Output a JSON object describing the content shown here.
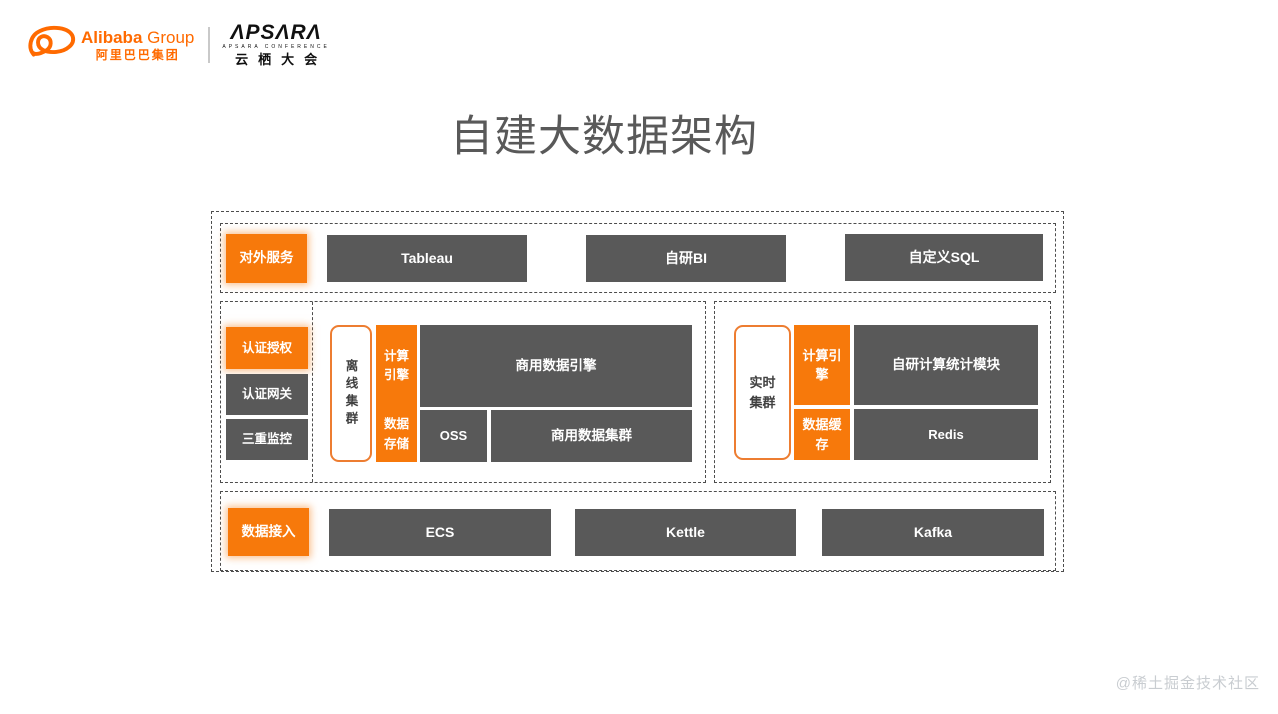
{
  "logos": {
    "alibaba": {
      "name_bold": "Alibaba",
      "name_light": " Group",
      "cn": "阿里巴巴集团"
    },
    "apsara": {
      "wordmark": "ΛPSΛRΛ",
      "subtitle": "APSARA CONFERENCE",
      "cn": "云栖大会"
    }
  },
  "title": "自建大数据架构",
  "watermark": "@稀土掘金技术社区",
  "colors": {
    "logo_orange": "#FF6A00",
    "block_orange": "#F7790B",
    "block_gray": "#595959",
    "dashed_border": "#4d4d4d",
    "title_gray": "#595959",
    "cluster_border_orange": "#ED7D31",
    "watermark_gray": "#c9cdd1"
  },
  "diagram": {
    "external_service": {
      "label": "对外服务"
    },
    "top_items": [
      {
        "label": "Tableau"
      },
      {
        "label": "自研BI"
      },
      {
        "label": "自定义SQL"
      }
    ],
    "auth_items": [
      {
        "label": "认证授权",
        "color": "orange"
      },
      {
        "label": "认证网关",
        "color": "gray"
      },
      {
        "label": "三重监控",
        "color": "gray"
      }
    ],
    "offline_cluster": {
      "label": "离线集群",
      "compute_engine": "计算引擎",
      "data_storage": "数据存储",
      "commercial_data_engine": "商用数据引擎",
      "oss": "OSS",
      "commercial_data_cluster": "商用数据集群"
    },
    "realtime_cluster": {
      "label": "实时集群",
      "compute_engine": "计算引擎",
      "data_cache": "数据缓存",
      "stat_module": "自研计算统计模块",
      "redis": "Redis"
    },
    "data_access": {
      "label": "数据接入"
    },
    "bottom_items": [
      {
        "label": "ECS"
      },
      {
        "label": "Kettle"
      },
      {
        "label": "Kafka"
      }
    ]
  }
}
